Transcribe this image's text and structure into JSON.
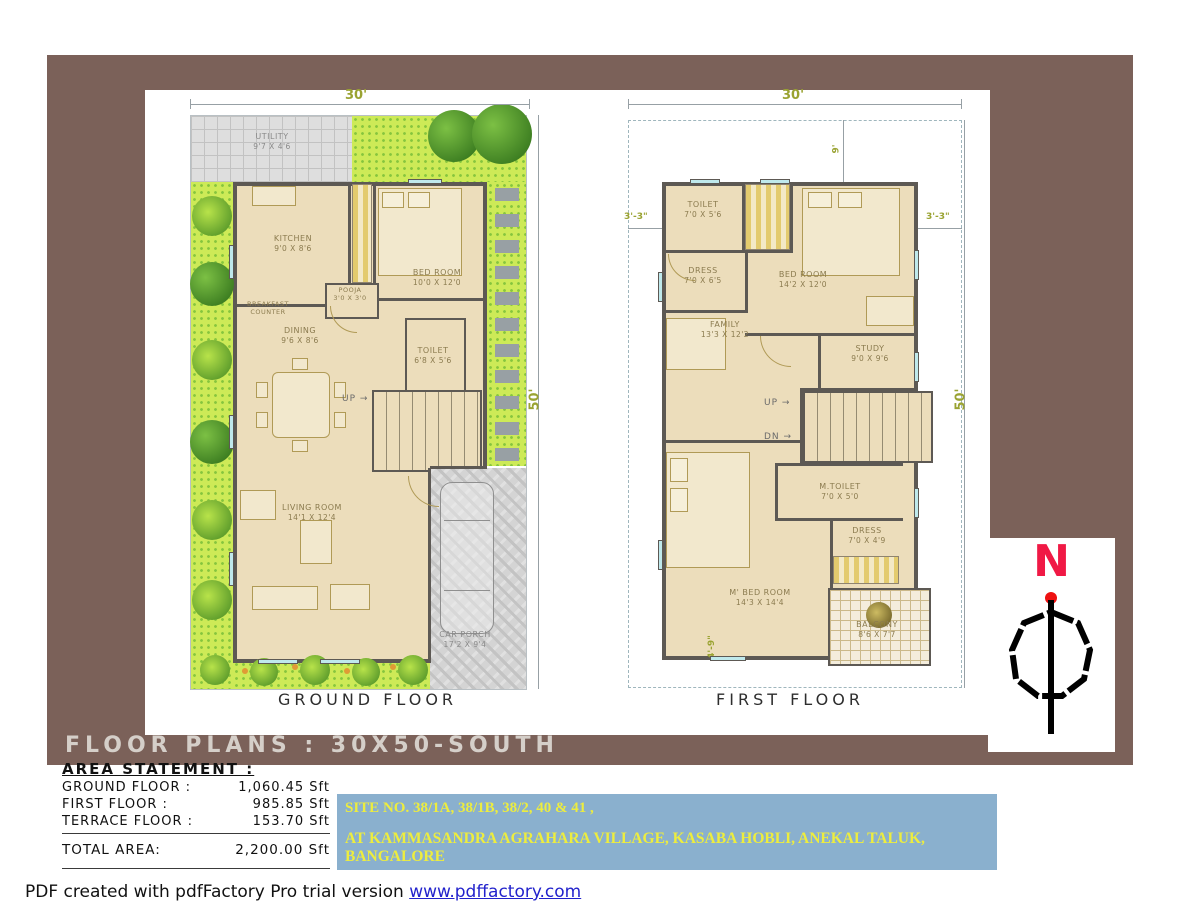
{
  "title_bar": {
    "title": "FLOOR PLANS : 30X50-SOUTH"
  },
  "compass": {
    "north_label": "N"
  },
  "ground_floor": {
    "caption": "GROUND FLOOR",
    "dim_width": "30'",
    "dim_height": "50'",
    "labels": {
      "up": "UP",
      "utility": {
        "name": "UTILITY",
        "size": "9'7 X 4'6"
      },
      "kitchen": {
        "name": "KITCHEN",
        "size": "9'0 X 8'6"
      },
      "breakfast": {
        "line1": "BREAKFAST",
        "line2": "COUNTER"
      },
      "bedroom": {
        "name": "BED ROOM",
        "size": "10'0 X 12'0"
      },
      "pooja": {
        "name": "POOJA",
        "size": "3'0 X 3'0"
      },
      "toilet": {
        "name": "TOILET",
        "size": "6'8 X 5'6"
      },
      "dining": {
        "name": "DINING",
        "size": "9'6 X 8'6"
      },
      "living": {
        "name": "LIVING ROOM",
        "size": "14'1 X 12'4"
      },
      "carporch": {
        "name": "CAR PORCH",
        "size": "17'2 X 9'4"
      }
    }
  },
  "first_floor": {
    "caption": "FIRST FLOOR",
    "dim_width": "30'",
    "dim_height": "50'",
    "dim_left": "3'-3\"",
    "dim_right": "3'-3\"",
    "dim_top": "9'",
    "dim_bottom": "4'-9\"",
    "labels": {
      "up": "UP",
      "dn": "DN",
      "toilet": {
        "name": "TOILET",
        "size": "7'0 X 5'6"
      },
      "dress1": {
        "name": "DRESS",
        "size": "7'0 X 6'5"
      },
      "bedroom": {
        "name": "BED ROOM",
        "size": "14'2 X 12'0"
      },
      "study": {
        "name": "STUDY",
        "size": "9'0 X 9'6"
      },
      "family": {
        "name": "FAMILY",
        "size": "13'3 X 12'2"
      },
      "mtoilet": {
        "name": "M.TOILET",
        "size": "7'0 X 5'0"
      },
      "dress2": {
        "name": "DRESS",
        "size": "7'0 X 4'9"
      },
      "mbedroom": {
        "name": "M' BED ROOM",
        "size": "14'3 X 14'4"
      },
      "balcony": {
        "name": "BALCONY",
        "size": "8'6 X 7'7"
      }
    }
  },
  "area_statement": {
    "heading": "AREA STATEMENT :",
    "rows": [
      {
        "label": "GROUND FLOOR :",
        "value": "1,060.45 Sft"
      },
      {
        "label": "FIRST FLOOR :",
        "value": "985.85 Sft"
      },
      {
        "label": "TERRACE FLOOR :",
        "value": "153.70 Sft"
      }
    ],
    "total_label": "TOTAL AREA:",
    "total_value": "2,200.00 Sft"
  },
  "site_info": {
    "line1": "SITE NO. 38/1A, 38/1B, 38/2, 40 & 41 ,",
    "line2": "AT KAMMASANDRA AGRAHARA VILLAGE, KASABA HOBLI, ANEKAL TALUK, BANGALORE"
  },
  "footer": {
    "text": "PDF created with pdfFactory Pro trial version",
    "link": "www.pdffactory.com"
  },
  "colors": {
    "frame_brown": "#7b6159",
    "floor_beige": "#ecddbb",
    "wall_gray": "#5d5954",
    "grass_green": "#cdea57",
    "dim_olive": "#9aa332",
    "site_box_blue": "#8ab0ce",
    "site_text_yellow": "#eded3e",
    "north_red": "#f01945",
    "link_blue": "#2222cc"
  }
}
